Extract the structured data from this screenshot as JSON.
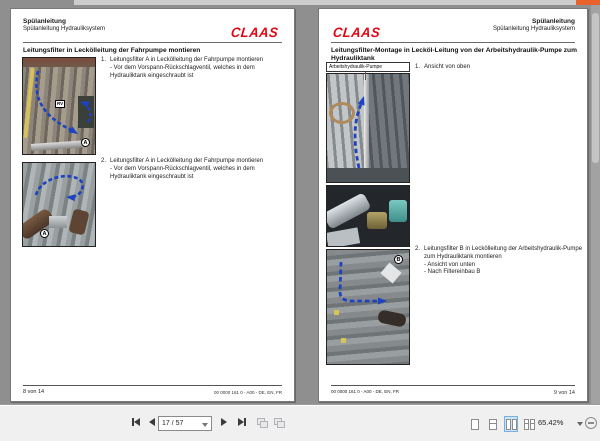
{
  "toolbar": {
    "page_value": "17 / 57",
    "zoom_value": "65.42%"
  },
  "left_page": {
    "header_line1": "Spülanleitung",
    "header_line2": "Spülanleitung Hydrauliksystem",
    "logo_text": "CLAAS",
    "title": "Leitungsfilter in Leckölleitung der Fahrpumpe montieren",
    "step1_num": "1.",
    "step1_text": "Leitungsfilter A in Leckölleitung der Fahrpumpe montieren",
    "step1_sub": "- Vor dem Vorspann-Rückschlagventil, welches in dem Hydrauliktank eingeschraubt ist",
    "step2_num": "2.",
    "step2_text": "Leitungsfilter A in Leckölleitung der Fahrpumpe montieren",
    "step2_sub": "- Vor dem Vorspann-Rückschlagventil, welches in dem Hydrauliktank eingeschraubt ist",
    "fig1_label": "RV",
    "fig1_marker": "A",
    "fig2_marker": "A",
    "footer_left": "8 von 14",
    "footer_right": "00 0000 161 0 - A00 - DE, EN, FR"
  },
  "right_page": {
    "header_line1": "Spülanleitung",
    "header_line2": "Spülanleitung Hydrauliksystem",
    "logo_text": "CLAAS",
    "title": "Leitungsfilter-Montage in Lecköl-Leitung von der Arbeitshydraulik-Pumpe zum Hydrauliktank",
    "callout": "Arbeitshydraulik-Pumpe",
    "step1_num": "1.",
    "step1_text": "Ansicht von oben",
    "step2_num": "2.",
    "step2_text": "Leitungsfilter B in Leckölleitung der Arbeitshydraulik-Pumpe zum Hydrauliktank montieren",
    "step2_sub1": "- Ansicht von unten",
    "step2_sub2": "- Nach Filtereinbau B",
    "fig3_marker": "B",
    "footer_left": "00 0000 161 0 - A00 - DE, EN, FR",
    "footer_right": "9 von 14"
  },
  "colors": {
    "claas_red": "#e30613",
    "arrow_blue": "#1d43c0",
    "canvas_gray": "#8f8f8f",
    "active_layout_highlight": "#cfe3f7"
  }
}
